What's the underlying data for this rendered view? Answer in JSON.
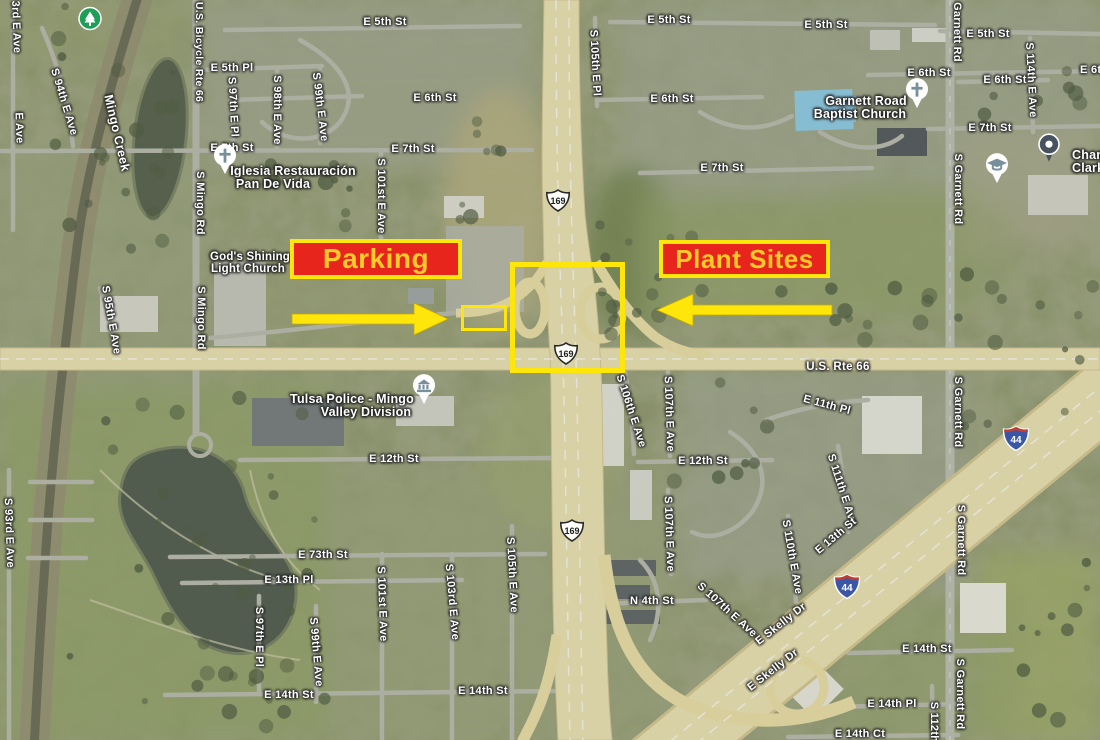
{
  "annotations": {
    "parking_label": "Parking",
    "plant_sites_label": "Plant Sites",
    "box_fill": "#e8251c",
    "box_border": "#ffe60a",
    "text_color": "#ffc928",
    "arrow_color": "#ffe60a"
  },
  "shields": [
    {
      "type": "us-route",
      "number": "169",
      "x": 558,
      "y": 203
    },
    {
      "type": "us-route",
      "number": "169",
      "x": 566,
      "y": 356
    },
    {
      "type": "us-route",
      "number": "169",
      "x": 572,
      "y": 533
    },
    {
      "type": "interstate",
      "number": "44",
      "x": 1016,
      "y": 441
    },
    {
      "type": "interstate",
      "number": "44",
      "x": 847,
      "y": 589
    }
  ],
  "poi": [
    {
      "kind": "park",
      "name": "park-tree-icon",
      "x": 90,
      "y": 21
    },
    {
      "kind": "church",
      "name": "church-icon",
      "x": 225,
      "y": 172
    },
    {
      "kind": "church",
      "name": "church-icon",
      "x": 917,
      "y": 106
    },
    {
      "kind": "civic",
      "name": "police-building-icon",
      "x": 424,
      "y": 402
    },
    {
      "kind": "school",
      "name": "school-icon",
      "x": 997,
      "y": 181
    },
    {
      "kind": "pin",
      "name": "poi-pin-icon",
      "x": 1049,
      "y": 160
    }
  ],
  "poi_labels": [
    {
      "text": "Iglesia Restauración",
      "x": 293,
      "y": 171
    },
    {
      "text": "Pan De Vida",
      "x": 273,
      "y": 184
    },
    {
      "text": "God's Shining",
      "x": 250,
      "y": 257,
      "s": 11.5
    },
    {
      "text": "Light Church",
      "x": 248,
      "y": 269,
      "s": 11.5
    },
    {
      "text": "Garnett Road",
      "x": 866,
      "y": 101
    },
    {
      "text": "Baptist Church",
      "x": 860,
      "y": 114
    },
    {
      "text": "Tulsa Police - Mingo",
      "x": 352,
      "y": 399
    },
    {
      "text": "Valley Division",
      "x": 366,
      "y": 412
    },
    {
      "text": "Champ",
      "x": 1072,
      "y": 155,
      "align": "left"
    },
    {
      "text": "Clark E",
      "x": 1072,
      "y": 168,
      "align": "left"
    }
  ],
  "map_labels": [
    {
      "text": "3rd E Ave",
      "x": 16,
      "y": 27,
      "r": 88
    },
    {
      "text": "E Ave",
      "x": 19,
      "y": 128,
      "r": 88
    },
    {
      "text": "S 94th E Ave",
      "x": 64,
      "y": 102,
      "r": 73
    },
    {
      "text": "Mingo Creek",
      "x": 117,
      "y": 133,
      "r": 77,
      "s": 12.5
    },
    {
      "text": "U.S. Bicycle Rte 66",
      "x": 199,
      "y": 52,
      "r": 90,
      "s": 10.5
    },
    {
      "text": "E 5th Pl",
      "x": 232,
      "y": 68,
      "r": 0
    },
    {
      "text": "S 97th E Pl",
      "x": 233,
      "y": 107,
      "r": 87
    },
    {
      "text": "S 98th E Ave",
      "x": 277,
      "y": 110,
      "r": 90
    },
    {
      "text": "S 99th E Ave",
      "x": 320,
      "y": 107,
      "r": 83
    },
    {
      "text": "E 5th St",
      "x": 385,
      "y": 22,
      "r": 0
    },
    {
      "text": "E 5th St",
      "x": 669,
      "y": 20,
      "r": 0
    },
    {
      "text": "E 5th St",
      "x": 826,
      "y": 25,
      "r": 0
    },
    {
      "text": "E 5th St",
      "x": 988,
      "y": 34,
      "r": 0
    },
    {
      "text": "Garnett Rd",
      "x": 957,
      "y": 32,
      "r": 90
    },
    {
      "text": "S 105th E Pl",
      "x": 595,
      "y": 63,
      "r": 87
    },
    {
      "text": "E 6th St",
      "x": 435,
      "y": 98,
      "r": 0
    },
    {
      "text": "E 6th St",
      "x": 672,
      "y": 99,
      "r": 0
    },
    {
      "text": "E 6th St",
      "x": 929,
      "y": 73,
      "r": 0
    },
    {
      "text": "E 6th St",
      "x": 1005,
      "y": 80,
      "r": 0
    },
    {
      "text": "E 6th St",
      "x": 1080,
      "y": 70,
      "r": 0,
      "align": "left"
    },
    {
      "text": "S 114th E Ave",
      "x": 1031,
      "y": 80,
      "r": 87
    },
    {
      "text": "E 7th St",
      "x": 232,
      "y": 148,
      "r": 0
    },
    {
      "text": "E 7th St",
      "x": 413,
      "y": 149,
      "r": 0
    },
    {
      "text": "E 7th St",
      "x": 722,
      "y": 168,
      "r": 0
    },
    {
      "text": "E 7th St",
      "x": 990,
      "y": 128,
      "r": 0
    },
    {
      "text": "S Mingo Rd",
      "x": 200,
      "y": 203,
      "r": 90
    },
    {
      "text": "S Mingo Rd",
      "x": 201,
      "y": 318,
      "r": 90
    },
    {
      "text": "S 101st E Ave",
      "x": 381,
      "y": 196,
      "r": 90
    },
    {
      "text": "S 95th E Ave",
      "x": 111,
      "y": 320,
      "r": 80
    },
    {
      "text": "U.S. Rte 66",
      "x": 838,
      "y": 367,
      "r": 0,
      "s": 11.5
    },
    {
      "text": "S Garnett Rd",
      "x": 958,
      "y": 189,
      "r": 90
    },
    {
      "text": "E 12th St",
      "x": 394,
      "y": 459,
      "r": 0
    },
    {
      "text": "E 12th St",
      "x": 703,
      "y": 461,
      "r": 0
    },
    {
      "text": "E 11th Pl",
      "x": 827,
      "y": 405,
      "r": 15
    },
    {
      "text": "S 106th E Ave",
      "x": 631,
      "y": 411,
      "r": 72
    },
    {
      "text": "S 107th E Ave",
      "x": 669,
      "y": 414,
      "r": 88
    },
    {
      "text": "S Garnett Rd",
      "x": 958,
      "y": 412,
      "r": 90
    },
    {
      "text": "S 93rd E Ave",
      "x": 9,
      "y": 533,
      "r": 88
    },
    {
      "text": "E 73th St",
      "x": 323,
      "y": 555,
      "r": 0
    },
    {
      "text": "E 13th Pl",
      "x": 289,
      "y": 580,
      "r": 0
    },
    {
      "text": "S 97th E Pl",
      "x": 259,
      "y": 637,
      "r": 90
    },
    {
      "text": "S 99th E Ave",
      "x": 316,
      "y": 652,
      "r": 85
    },
    {
      "text": "S 101st E Ave",
      "x": 382,
      "y": 604,
      "r": 88
    },
    {
      "text": "S 103rd E Ave",
      "x": 452,
      "y": 602,
      "r": 85
    },
    {
      "text": "S 105th E Ave",
      "x": 512,
      "y": 575,
      "r": 87
    },
    {
      "text": "S 107th E Ave",
      "x": 669,
      "y": 534,
      "r": 88
    },
    {
      "text": "S 111th E Ave",
      "x": 842,
      "y": 490,
      "r": 72
    },
    {
      "text": "E 13th St",
      "x": 836,
      "y": 536,
      "r": -40
    },
    {
      "text": "S 110th E Ave",
      "x": 792,
      "y": 557,
      "r": 80
    },
    {
      "text": "S Garnett Rd",
      "x": 961,
      "y": 540,
      "r": 90
    },
    {
      "text": "E 14th St",
      "x": 289,
      "y": 695,
      "r": 0
    },
    {
      "text": "E 14th St",
      "x": 483,
      "y": 691,
      "r": 0
    },
    {
      "text": "N 4th St",
      "x": 652,
      "y": 601,
      "r": 0
    },
    {
      "text": "S 107th E Ave",
      "x": 727,
      "y": 610,
      "r": 42
    },
    {
      "text": "E Skelly Dr",
      "x": 781,
      "y": 624,
      "r": -38
    },
    {
      "text": "E Skelly Dr",
      "x": 773,
      "y": 670,
      "r": -38
    },
    {
      "text": "E 14th St",
      "x": 927,
      "y": 649,
      "r": 0
    },
    {
      "text": "E 14th Pl",
      "x": 892,
      "y": 704,
      "r": 0
    },
    {
      "text": "E 14th Ct",
      "x": 860,
      "y": 734,
      "r": 0
    },
    {
      "text": "S 112th",
      "x": 934,
      "y": 722,
      "r": 90
    },
    {
      "text": "S Garnett Rd",
      "x": 960,
      "y": 694,
      "r": 90
    }
  ]
}
